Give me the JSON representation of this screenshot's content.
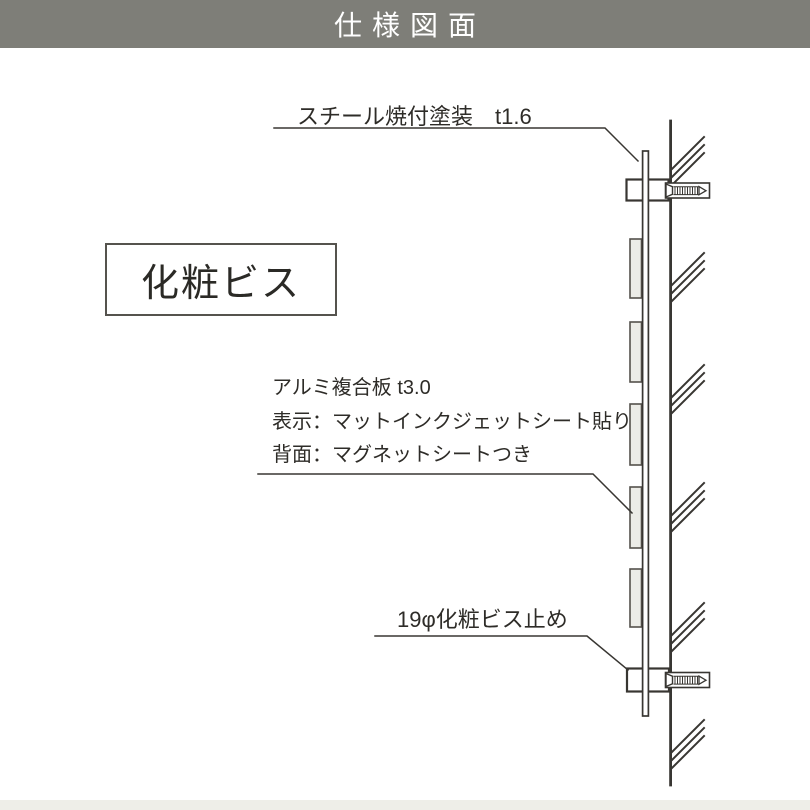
{
  "header": {
    "title": "仕様図面",
    "bg_color": "#7e7e78",
    "text_color": "#ffffff"
  },
  "diagram": {
    "line_color": "#383632",
    "labels": {
      "steel_note": "スチール焼付塗装　t1.6",
      "decorative_screw": "化粧ビス",
      "panel_spec_1": "アルミ複合板 t3.0",
      "panel_spec_2": "表示：マットインクジェットシート貼り",
      "panel_spec_3": "背面：マグネットシートつき",
      "bottom_note": "19φ化粧ビス止め"
    }
  },
  "footer": {
    "bg_color": "#eeeee8"
  }
}
